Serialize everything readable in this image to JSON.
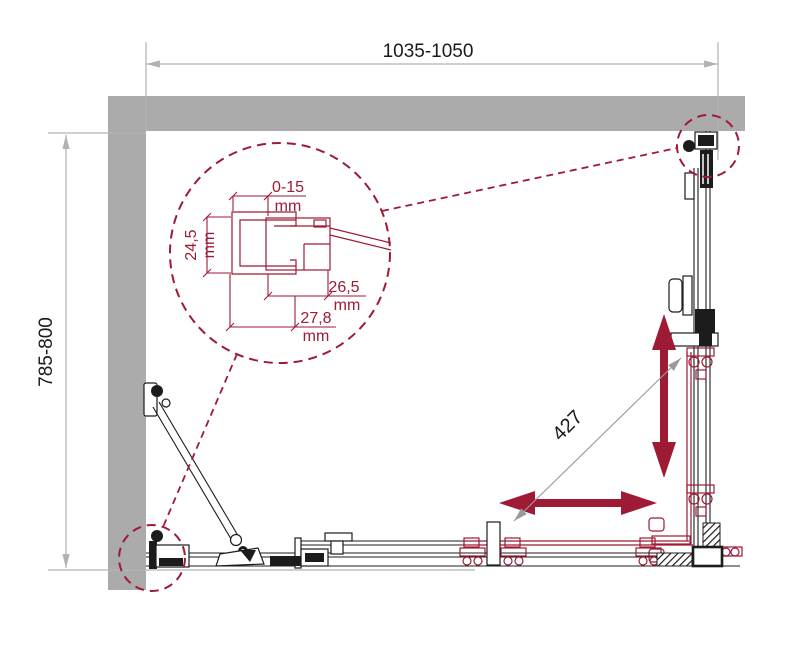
{
  "dimensions": {
    "width": "1035-1050",
    "depth": "785-800",
    "door_opening": "427"
  },
  "detail": {
    "adjustment": "0-15",
    "adjustment_unit": "mm",
    "profile_depth": "24,5",
    "profile_depth_unit": "mm",
    "inner_width": "26,5",
    "inner_width_unit": "mm",
    "outer_width": "27,8",
    "outer_width_unit": "mm"
  },
  "colors": {
    "wall_gray": "#ababab",
    "dimension_gray": "#b2b2b6",
    "accent_crimson": "#9e1a35",
    "drawing_black": "#1c1c1c"
  }
}
